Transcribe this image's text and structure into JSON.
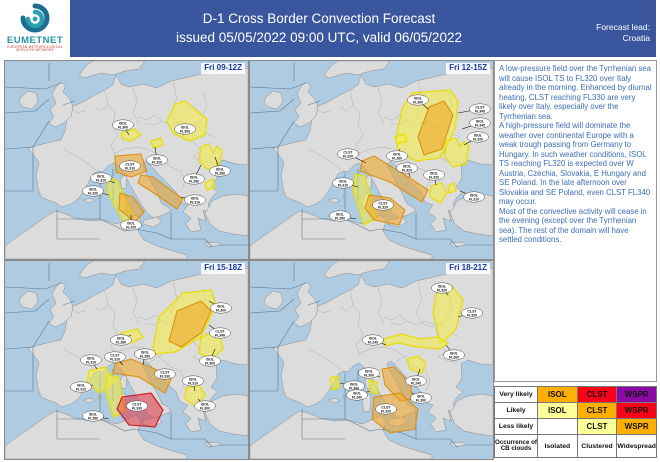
{
  "header": {
    "logo": {
      "name": "EUMETNET",
      "tagline1": "EUROPEAN METEOROLOGICAL",
      "tagline2": "SERVICES NETWORK"
    },
    "title_line1": "D-1 Cross Border Convection Forecast",
    "title_line2": "issued 05/05/2022 09:00 UTC, valid 06/05/2022",
    "lead_label": "Forecast lead:",
    "lead_value": "Croatia"
  },
  "forecast_text": {
    "p1": "A low-pressure field over the Tyrrhenian sea will cause ISOL TS to FL320 over Italy already in the morning. Enhanced by diurnal heating, CLST reaching FL330 are very likely over Italy, especially over the Tyrrhenian sea.",
    "p2": "A high-pressure field will dominate the weather over continental Europe with a weak trough passing from Germany to Hungary. In such weather conditions, ISOL TS reaching FL320 is expected over W Austria, Czechia, Slovakia, E Hungary and SE Poland. In the late afternoon over Slovakia and SE Poland, even CLST FL340 may occur.",
    "p3": "Most of the convective activity will cease in the evening (except over the Tyrrhenian sea). The rest of the domain will have settled conditions."
  },
  "legend": {
    "rows": [
      {
        "label": "Very likely",
        "cells": [
          {
            "text": "ISOL",
            "bg": "orange"
          },
          {
            "text": "CLST",
            "bg": "red"
          },
          {
            "text": "WSPR",
            "bg": "purple"
          }
        ]
      },
      {
        "label": "Likely",
        "cells": [
          {
            "text": "ISOL",
            "bg": "paleyellow"
          },
          {
            "text": "CLST",
            "bg": "orange"
          },
          {
            "text": "WSPR",
            "bg": "red"
          }
        ]
      },
      {
        "label": "Less likely",
        "cells": [
          {
            "text": "",
            "bg": "white"
          },
          {
            "text": "CLST",
            "bg": "paleyellow"
          },
          {
            "text": "WSPR",
            "bg": "orange"
          }
        ]
      },
      {
        "label": "Occurrence of CB clouds",
        "cells": [
          {
            "text": "Isolated",
            "bg": "white"
          },
          {
            "text": "Clustered",
            "bg": "white"
          },
          {
            "text": "Widespread",
            "bg": "white"
          }
        ]
      }
    ]
  },
  "colors": {
    "orange": "#FFAF00",
    "red": "#FA0019",
    "purple": "#8B0AA5",
    "paleyellow": "#FFFF99",
    "white": "#FFFFFF",
    "sea": "#AECBE2",
    "land": "#DCDCDC",
    "coast": "#8C8C8C",
    "border": "#A5A5A5",
    "fir": "#46627C",
    "region_yellow": "#F6EC3E",
    "region_yellow_stroke": "#E8DC00",
    "region_orange": "#F0A320",
    "region_orange_stroke": "#D98E0A",
    "region_red": "#E23540",
    "region_red_stroke": "#C41020"
  },
  "map_base": {
    "land": [
      "57,51 66,46 78,41 90,34 100,29 106,25 108,24 111,14 116,23 124,26 138,23 152,27 166,20 184,16 205,11 243,7 243,104 230,103 218,99 211,103 212,117 206,126 213,131 207,136 203,143 206,152 198,149 201,160 193,157 196,169 186,171 181,163 186,157 178,151 183,144 175,141 171,131 164,124 156,116 148,107 141,100 137,103 141,112 147,123 153,134 157,143 163,146 166,150 158,154 149,157 143,153 136,143 129,131 122,118 116,108 109,102 103,105 98,111 93,110 88,113 81,126 74,137 66,143 57,146 51,142 43,139 36,136 33,127 31,114 34,101 28,93 23,87 34,84 46,81 56,79 60,70 62,58",
      "55,21 61,24 58,31 65,38 68,46 66,55 59,62 50,66 44,62 49,56 45,49 51,42 47,33 51,26",
      "16,36 23,30 31,32 33,41 27,48 18,46 14,41",
      "74,14 82,4 88,0 140,0 134,8 120,10 108,14 96,12 86,15 79,17",
      "207,140 218,135 232,133 243,135 243,175 228,173 214,170 205,163 200,152 204,146",
      "0,185 12,176 28,165 42,155 50,150 58,152 70,157 84,160 98,159 112,163 124,158 131,154 136,160 133,170 139,179 152,185 168,190 182,194 182,198 0,198",
      "118,114 122,116 121,127 117,128 115,120",
      "116,132 121,134 120,150 114,151 112,140",
      "139,159 152,156 157,161 148,166 138,163",
      "79,139 85,137 90,140 84,142",
      "93,134 97,136 94,138",
      "200,182 212,181 216,184 203,186"
    ],
    "country_borders": [
      "58,88 70,94 82,102 91,109",
      "100,30 103,44 110,52 108,64 113,74 106,84 110,94",
      "128,27 132,40 128,52 134,62",
      "134,56 142,59 150,54 157,60 150,64 140,62",
      "110,92 120,88 132,86 142,88 150,92",
      "168,21 172,38 166,52 172,62",
      "157,60 166,64 176,60 186,64 196,60",
      "172,62 182,66 192,64 200,72 210,76",
      "150,92 158,100 166,106 176,110",
      "176,110 180,120 176,130",
      "186,64 188,80 196,90 188,96",
      "188,96 198,100 208,102",
      "196,60 202,44 198,30",
      "143,103 150,98 158,94",
      "66,46 72,52 80,50",
      "103,44 96,50 90,46"
    ],
    "fir_lines": [
      "0,26 40,28 56,22",
      "0,52 30,50 44,38",
      "0,88 28,86 44,60",
      "28,86 28,130 0,130",
      "52,148 52,178 95,178",
      "95,112 95,158 52,158",
      "95,158 108,164 120,170 130,168",
      "108,108 108,140",
      "130,168 152,172 166,178 166,152",
      "166,178 200,178 207,186",
      "216,184 243,184",
      "58,44 70,40",
      "44,20 44,2"
    ]
  },
  "panels": [
    {
      "time_label": "Fri 09-12Z",
      "regions": [
        {
          "type": "yellow",
          "points": "116,72 130,68 136,74 126,80 118,78"
        },
        {
          "type": "yellow",
          "points": "162,60 170,43 180,40 202,58 200,74 184,80 168,72"
        },
        {
          "type": "yellow",
          "points": "196,86 204,83 208,92 212,85 217,90 214,106 202,108 194,100"
        },
        {
          "type": "yellow",
          "points": "200,122 208,118 210,127 202,129"
        },
        {
          "type": "yellow",
          "points": "146,80 156,77 158,84 148,87"
        },
        {
          "type": "orange",
          "points": "110,95 136,93 142,110 126,116 111,111"
        },
        {
          "type": "orange",
          "points": "136,114 148,116 178,138 172,148 146,130 133,122"
        },
        {
          "type": "yellow",
          "points": "103,117 112,119 128,154 119,162 102,130"
        },
        {
          "type": "orange",
          "points": "115,132 128,136 139,151 130,161 114,148"
        }
      ],
      "labels": [
        {
          "l1": "ISOL",
          "l2": "FL300",
          "x": 118,
          "y": 64,
          "tx": 124,
          "ty": 74
        },
        {
          "l1": "ISOL",
          "l2": "FL300",
          "x": 180,
          "y": 68,
          "tx": 178,
          "ty": 74
        },
        {
          "l1": "CLST",
          "l2": "FL310",
          "x": 125,
          "y": 105
        },
        {
          "l1": "ISOL",
          "l2": "FL320",
          "x": 152,
          "y": 99,
          "tx": 150,
          "ty": 86
        },
        {
          "l1": "ISOL",
          "l2": "FL310",
          "x": 96,
          "y": 117,
          "tx": 110,
          "ty": 122
        },
        {
          "l1": "ISOL",
          "l2": "FL320",
          "x": 88,
          "y": 130,
          "tx": 104,
          "ty": 134
        },
        {
          "l1": "ISOL",
          "l2": "FL280",
          "x": 189,
          "y": 118,
          "tx": 196,
          "ty": 104
        },
        {
          "l1": "ISOL",
          "l2": "FL280",
          "x": 215,
          "y": 110,
          "tx": 210,
          "ty": 96
        },
        {
          "l1": "ISOL",
          "l2": "FL310",
          "x": 190,
          "y": 139,
          "tx": 176,
          "ty": 136
        },
        {
          "l1": "ISOL",
          "l2": "FL320",
          "x": 126,
          "y": 164,
          "tx": 126,
          "ty": 154
        }
      ]
    },
    {
      "time_label": "Fri 12-15Z",
      "regions": [
        {
          "type": "yellow",
          "points": "146,78 152,48 162,32 200,29 208,40 205,68 190,97 166,100 148,90"
        },
        {
          "type": "orange",
          "points": "168,76 179,46 194,40 203,54 192,88 174,94"
        },
        {
          "type": "yellow",
          "points": "196,80 206,77 210,86 214,80 219,85 216,103 203,106 195,96"
        },
        {
          "type": "orange",
          "points": "112,100 124,95 152,112 178,129 172,141 140,121 110,110"
        },
        {
          "type": "yellow",
          "points": "105,113 115,115 127,157 114,164 103,130"
        },
        {
          "type": "orange",
          "points": "119,134 140,137 155,149 149,164 124,159 115,147"
        },
        {
          "type": "yellow",
          "points": "181,125 192,122 197,132 190,142 180,136"
        },
        {
          "type": "yellow",
          "points": "145,76 155,73 157,80 147,83"
        },
        {
          "type": "yellow",
          "points": "198,125 204,122 206,130 199,132"
        }
      ],
      "labels": [
        {
          "l1": "ISOL",
          "l2": "FL300",
          "x": 168,
          "y": 39,
          "tx": 178,
          "ty": 48
        },
        {
          "l1": "CLST",
          "l2": "FL340",
          "x": 230,
          "y": 48,
          "tx": 208,
          "ty": 52
        },
        {
          "l1": "ISOL",
          "l2": "FL340",
          "x": 230,
          "y": 62,
          "tx": 212,
          "ty": 68
        },
        {
          "l1": "ISOL",
          "l2": "FL320",
          "x": 228,
          "y": 76,
          "tx": 214,
          "ty": 84
        },
        {
          "l1": "CLST",
          "l2": "FL320",
          "x": 98,
          "y": 93,
          "tx": 116,
          "ty": 102
        },
        {
          "l1": "ISOL",
          "l2": "FL280",
          "x": 147,
          "y": 95,
          "tx": 150,
          "ty": 88
        },
        {
          "l1": "ISOL",
          "l2": "FL320",
          "x": 157,
          "y": 107,
          "tx": 160,
          "ty": 116
        },
        {
          "l1": "ISOL",
          "l2": "FL320",
          "x": 184,
          "y": 114,
          "tx": 186,
          "ty": 124
        },
        {
          "l1": "ISOL",
          "l2": "FL310",
          "x": 93,
          "y": 122,
          "tx": 108,
          "ty": 126
        },
        {
          "l1": "CLST",
          "l2": "FL320",
          "x": 133,
          "y": 144
        },
        {
          "l1": "ISOL",
          "l2": "FL280",
          "x": 90,
          "y": 155,
          "tx": 106,
          "ty": 158
        },
        {
          "l1": "ISOL",
          "l2": "FL310",
          "x": 224,
          "y": 136,
          "tx": 210,
          "ty": 130
        }
      ]
    },
    {
      "time_label": "Fri 15-18Z",
      "regions": [
        {
          "type": "yellow",
          "points": "148,86 154,56 178,32 206,29 211,44 196,76 170,91 150,93"
        },
        {
          "type": "orange",
          "points": "164,80 172,50 196,40 206,50 196,72 176,86"
        },
        {
          "type": "yellow",
          "points": "196,76 214,70 218,88 206,98 194,92"
        },
        {
          "type": "yellow",
          "points": "116,72 132,68 138,76 126,82 116,80"
        },
        {
          "type": "orange",
          "points": "110,103 126,98 150,108 166,118 160,132 134,116 108,112"
        },
        {
          "type": "yellow",
          "points": "84,110 100,106 110,120 95,132 82,122"
        },
        {
          "type": "yellow",
          "points": "103,114 114,116 120,150 108,156 100,128"
        },
        {
          "type": "red",
          "points": "117,136 146,132 158,149 150,166 124,164 112,148"
        },
        {
          "type": "yellow",
          "points": "181,127 194,124 200,134 192,146 180,138"
        }
      ],
      "labels": [
        {
          "l1": "ISOL",
          "l2": "FL300",
          "x": 216,
          "y": 47,
          "tx": 204,
          "ty": 40
        },
        {
          "l1": "CLST",
          "l2": "FL340",
          "x": 215,
          "y": 72,
          "tx": 204,
          "ty": 64
        },
        {
          "l1": "ISOL",
          "l2": "FL300",
          "x": 205,
          "y": 100,
          "tx": 210,
          "ty": 88
        },
        {
          "l1": "ISOL",
          "l2": "FL280",
          "x": 116,
          "y": 79,
          "tx": 126,
          "ty": 74
        },
        {
          "l1": "CLST",
          "l2": "FL310",
          "x": 110,
          "y": 96,
          "tx": 118,
          "ty": 104
        },
        {
          "l1": "ISOL",
          "l2": "FL280",
          "x": 140,
          "y": 93,
          "tx": 138,
          "ty": 104
        },
        {
          "l1": "CLST",
          "l2": "FL330",
          "x": 160,
          "y": 113,
          "tx": 152,
          "ty": 116
        },
        {
          "l1": "ISOL",
          "l2": "FL310",
          "x": 188,
          "y": 120,
          "tx": 190,
          "ty": 130
        },
        {
          "l1": "ISOL",
          "l2": "FL310",
          "x": 86,
          "y": 99,
          "tx": 92,
          "ty": 108
        },
        {
          "l1": "ISOL",
          "l2": "FL310",
          "x": 76,
          "y": 126,
          "tx": 88,
          "ty": 124
        },
        {
          "l1": "CLST",
          "l2": "FL330",
          "x": 132,
          "y": 145
        },
        {
          "l1": "ISOL",
          "l2": "FL280",
          "x": 88,
          "y": 155,
          "tx": 104,
          "ty": 158
        },
        {
          "l1": "ISOL",
          "l2": "FL300",
          "x": 200,
          "y": 145,
          "tx": 193,
          "ty": 138
        }
      ]
    },
    {
      "time_label": "Fri 18-21Z",
      "regions": [
        {
          "type": "yellow",
          "points": "183,52 187,30 201,24 213,39 206,68 191,83"
        },
        {
          "type": "yellow",
          "points": "133,78 152,73 170,78 188,76 198,82 190,88 168,86 148,82 135,85"
        },
        {
          "type": "yellow",
          "points": "157,98 168,95 176,102 172,112 160,108"
        },
        {
          "type": "orange",
          "points": "132,108 144,106 160,122 163,138 150,140 135,124"
        },
        {
          "type": "orange",
          "points": "124,136 150,132 168,148 165,168 140,172 122,158"
        },
        {
          "type": "yellow",
          "points": "80,117 88,115 90,126 82,129"
        },
        {
          "type": "yellow",
          "points": "119,119 127,121 128,133 120,131"
        }
      ],
      "labels": [
        {
          "l1": "ISOL",
          "l2": "FL320",
          "x": 192,
          "y": 27,
          "tx": 198,
          "ty": 34
        },
        {
          "l1": "CLST",
          "l2": "FL330",
          "x": 222,
          "y": 52,
          "tx": 208,
          "ty": 56
        },
        {
          "l1": "ISOL",
          "l2": "FL260",
          "x": 204,
          "y": 94,
          "tx": 196,
          "ty": 84
        },
        {
          "l1": "ISOL",
          "l2": "FL240",
          "x": 123,
          "y": 79,
          "tx": 136,
          "ty": 84
        },
        {
          "l1": "ISOL",
          "l2": "FL300",
          "x": 119,
          "y": 112,
          "tx": 130,
          "ty": 116
        },
        {
          "l1": "ISOL",
          "l2": "FL300",
          "x": 104,
          "y": 125,
          "tx": 90,
          "ty": 122
        },
        {
          "l1": "ISOL",
          "l2": "FL280",
          "x": 107,
          "y": 134,
          "tx": 120,
          "ty": 130
        },
        {
          "l1": "ISOL",
          "l2": "FL240",
          "x": 166,
          "y": 120,
          "tx": 170,
          "ty": 108
        },
        {
          "l1": "ISOL",
          "l2": "FL300",
          "x": 171,
          "y": 137,
          "tx": 162,
          "ty": 132
        },
        {
          "l1": "CLST",
          "l2": "FL320",
          "x": 136,
          "y": 148
        }
      ]
    }
  ]
}
